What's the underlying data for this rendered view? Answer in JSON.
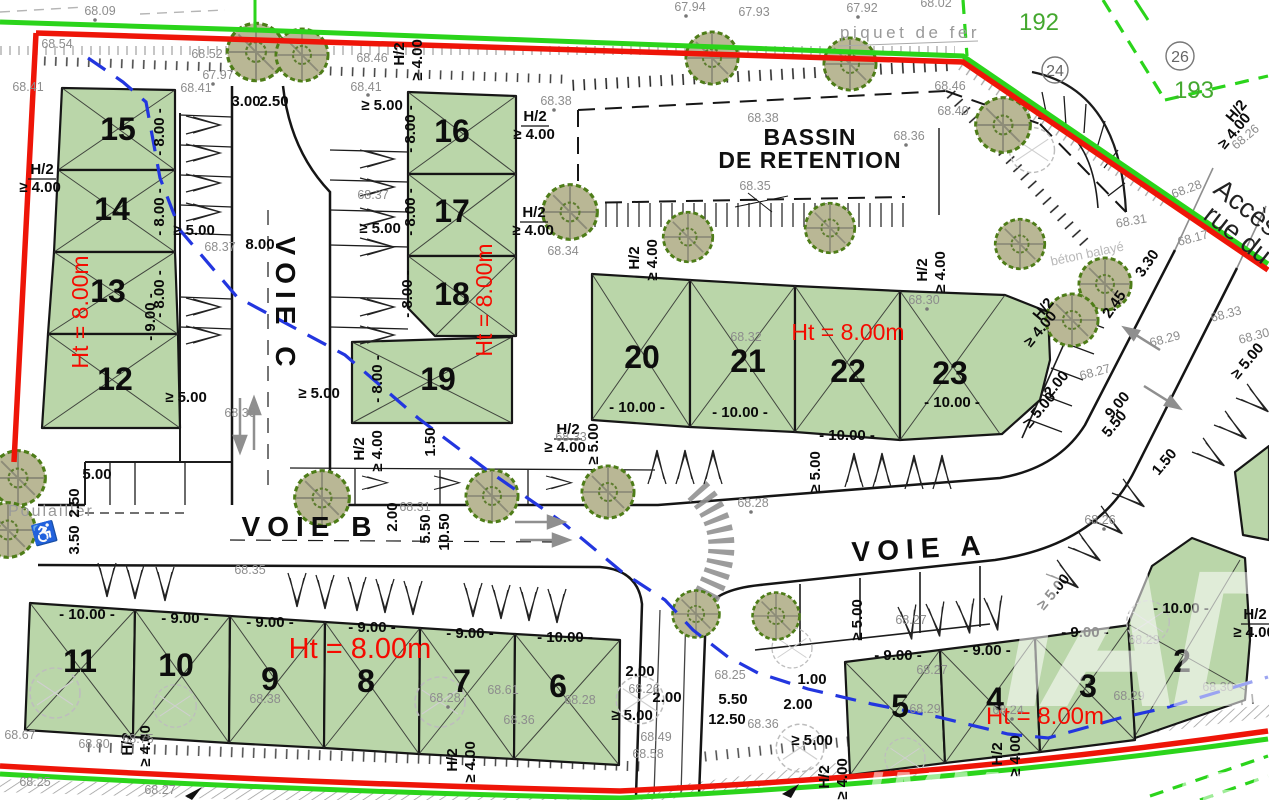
{
  "roads": {
    "voie_a": "VOIE A",
    "voie_b": "VOIE B",
    "voie_c": "VOIE C"
  },
  "bassin": {
    "line1": "BASSIN",
    "line2": "DE RETENTION"
  },
  "height_label": "Ht = 8.00m",
  "neighbors": {
    "p192": "192",
    "p193": "193",
    "c24": "24",
    "c26": "26"
  },
  "annotations": {
    "piquet": "piquet de fer",
    "poulailler": "Poulailler",
    "acces1": "Accès",
    "acces2": "rue du",
    "beton": "béton balayé"
  },
  "watermark": {
    "monogram": "IAD",
    "label": "IMMOBILIER"
  },
  "plot_numbers": [
    "15",
    "14",
    "13",
    "12",
    "16",
    "17",
    "18",
    "19",
    "20",
    "21",
    "22",
    "23",
    "11",
    "10",
    "9",
    "8",
    "7",
    "6",
    "5",
    "4",
    "3",
    "2"
  ],
  "dims": [
    "- 8.00 -",
    "- 9.00 -",
    "- 10.00 -",
    "H/2",
    "≥ 4.00",
    "≥ 5.00",
    "5.00",
    "3.00",
    "2.50",
    "3.50",
    "8.00",
    "2.00",
    "5.50",
    "10.50",
    "1.50",
    "12.50",
    "9.00",
    "3.30",
    "2.45",
    "1.00"
  ],
  "elevations": [
    "68.09",
    "67.97",
    "67.94",
    "67.93",
    "67.92",
    "68.02",
    "68.54",
    "68.52",
    "68.46",
    "68.41",
    "68.41",
    "68.41",
    "68.38",
    "68.38",
    "68.36",
    "68.35",
    "68.40",
    "68.46",
    "68.26",
    "68.28",
    "68.31",
    "68.17",
    "68.34",
    "68.37",
    "68.37",
    "68.33",
    "68.30",
    "68.32",
    "68.30",
    "68.29",
    "68.27",
    "68.36",
    "68.31",
    "68.28",
    "68.33",
    "68.35",
    "68.38",
    "68.28",
    "68.61",
    "68.36",
    "68.28",
    "68.49",
    "68.58",
    "68.67",
    "68.80",
    "68.75",
    "68.25",
    "68.27",
    "68.25",
    "68.26",
    "68.36",
    "68.24",
    "68.29",
    "68.27",
    "68.27",
    "68.26",
    "68.29",
    "68.29",
    "68.30"
  ],
  "colors": {
    "plot_green": "#bad6a9",
    "boundary_red": "#ee1508",
    "boundary_green": "#2bd41b",
    "blue_line": "#2336df",
    "red_text": "#f50b00",
    "green_text": "#44a82f",
    "tree_fill": "#b9b795",
    "tree_stroke": "#4e7d18"
  }
}
